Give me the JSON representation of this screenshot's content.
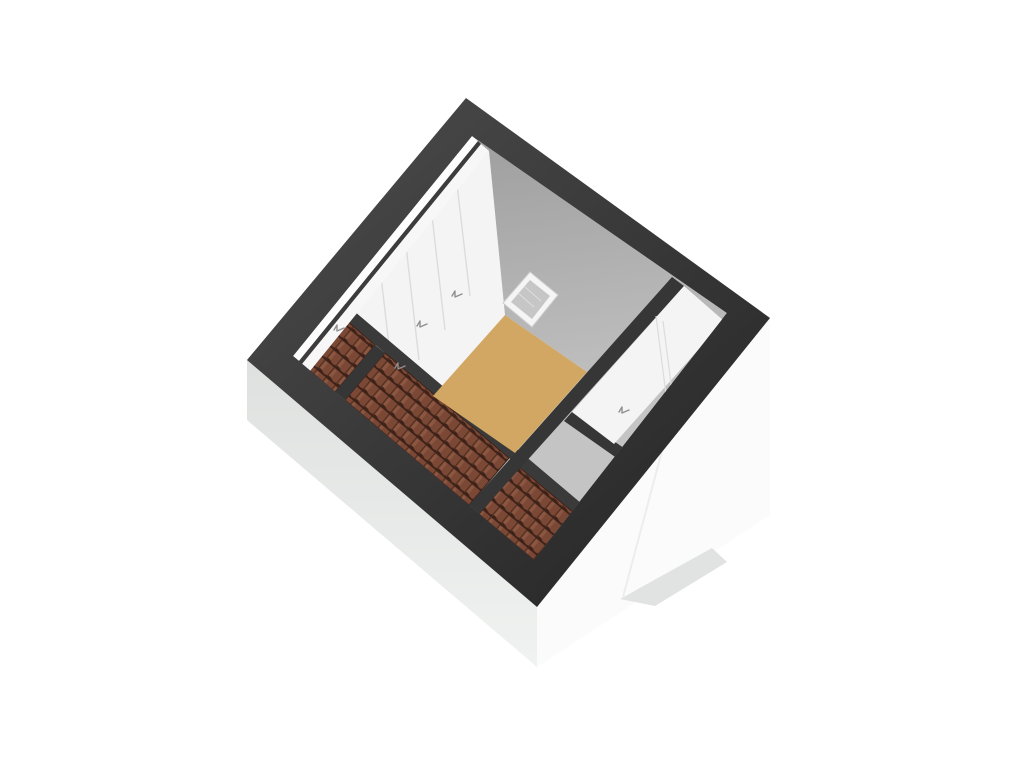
{
  "scene": {
    "type": "3d-floorplan-render",
    "floor_label": "attic-floor",
    "background": "#ffffff",
    "colors": {
      "band_light": "#464646",
      "band_dark": "#2b2b2b",
      "inner_wall": "#f3f4f3",
      "wall_strip_bright": "#fdfdfd",
      "wall_strip_soft": "#f6f7f6",
      "wall_slit": "#3c3c3c",
      "wall_seam": "#dcdcdc",
      "slope_top": "#a2a2a2",
      "slope_bottom": "#c4c4c4",
      "floor_fill": "#d2a763",
      "knee_band": "#3a3a3a",
      "partition_band": "#363636",
      "tile_base": "#7c4836",
      "tile_gap": "#54301f",
      "tile_row": "#3d2219",
      "tile_highlight": "#95604a",
      "prism_left_top": "#dfe1e0",
      "prism_left_bottom": "#f1f3f2",
      "prism_right": "#fbfbfb",
      "prism_edge": "#ededed",
      "gable_shadow": "#e1e3e2",
      "skylight_frame": "#f5f5f5",
      "skylight_frame_edge": "#cfcfcf",
      "skylight_glass": "#c6c6c6",
      "skylight_streak": "#dedede",
      "glyph": "#8f8f8f"
    }
  }
}
